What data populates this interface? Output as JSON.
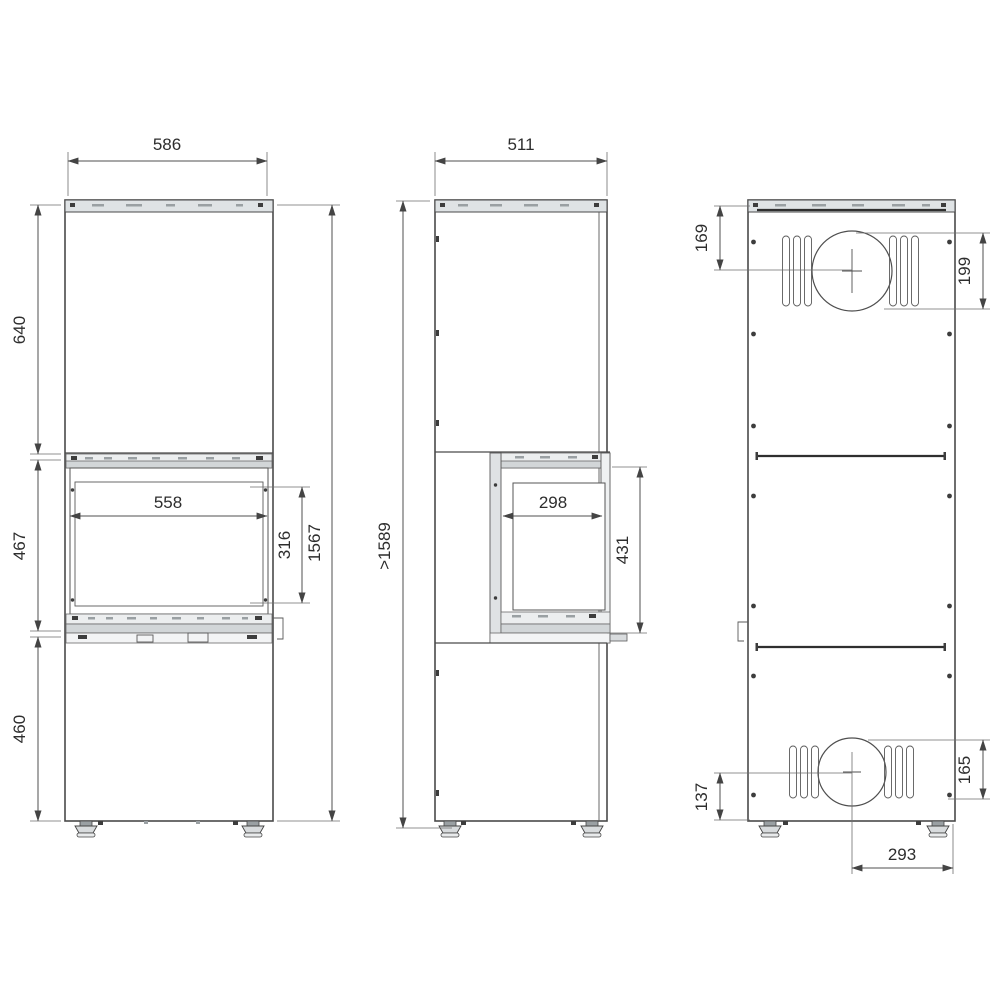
{
  "drawing": {
    "front_view": {
      "overall_width": "586",
      "upper_section_height": "640",
      "firebox_section_height": "467",
      "base_section_height": "460",
      "body_total_height": "1567",
      "glass_opening_width": "558",
      "glass_opening_height": "316"
    },
    "side_view": {
      "overall_depth": "511",
      "min_total_height": ">1589",
      "glass_opening_depth": "298",
      "door_opening_height": "431"
    },
    "rear_view": {
      "top_flue_center_from_top": "169",
      "top_flue_vertical_extent": "199",
      "bottom_flue_center_from_base": "137",
      "bottom_flue_vertical_extent": "165",
      "bottom_flue_center_from_right": "293"
    }
  }
}
